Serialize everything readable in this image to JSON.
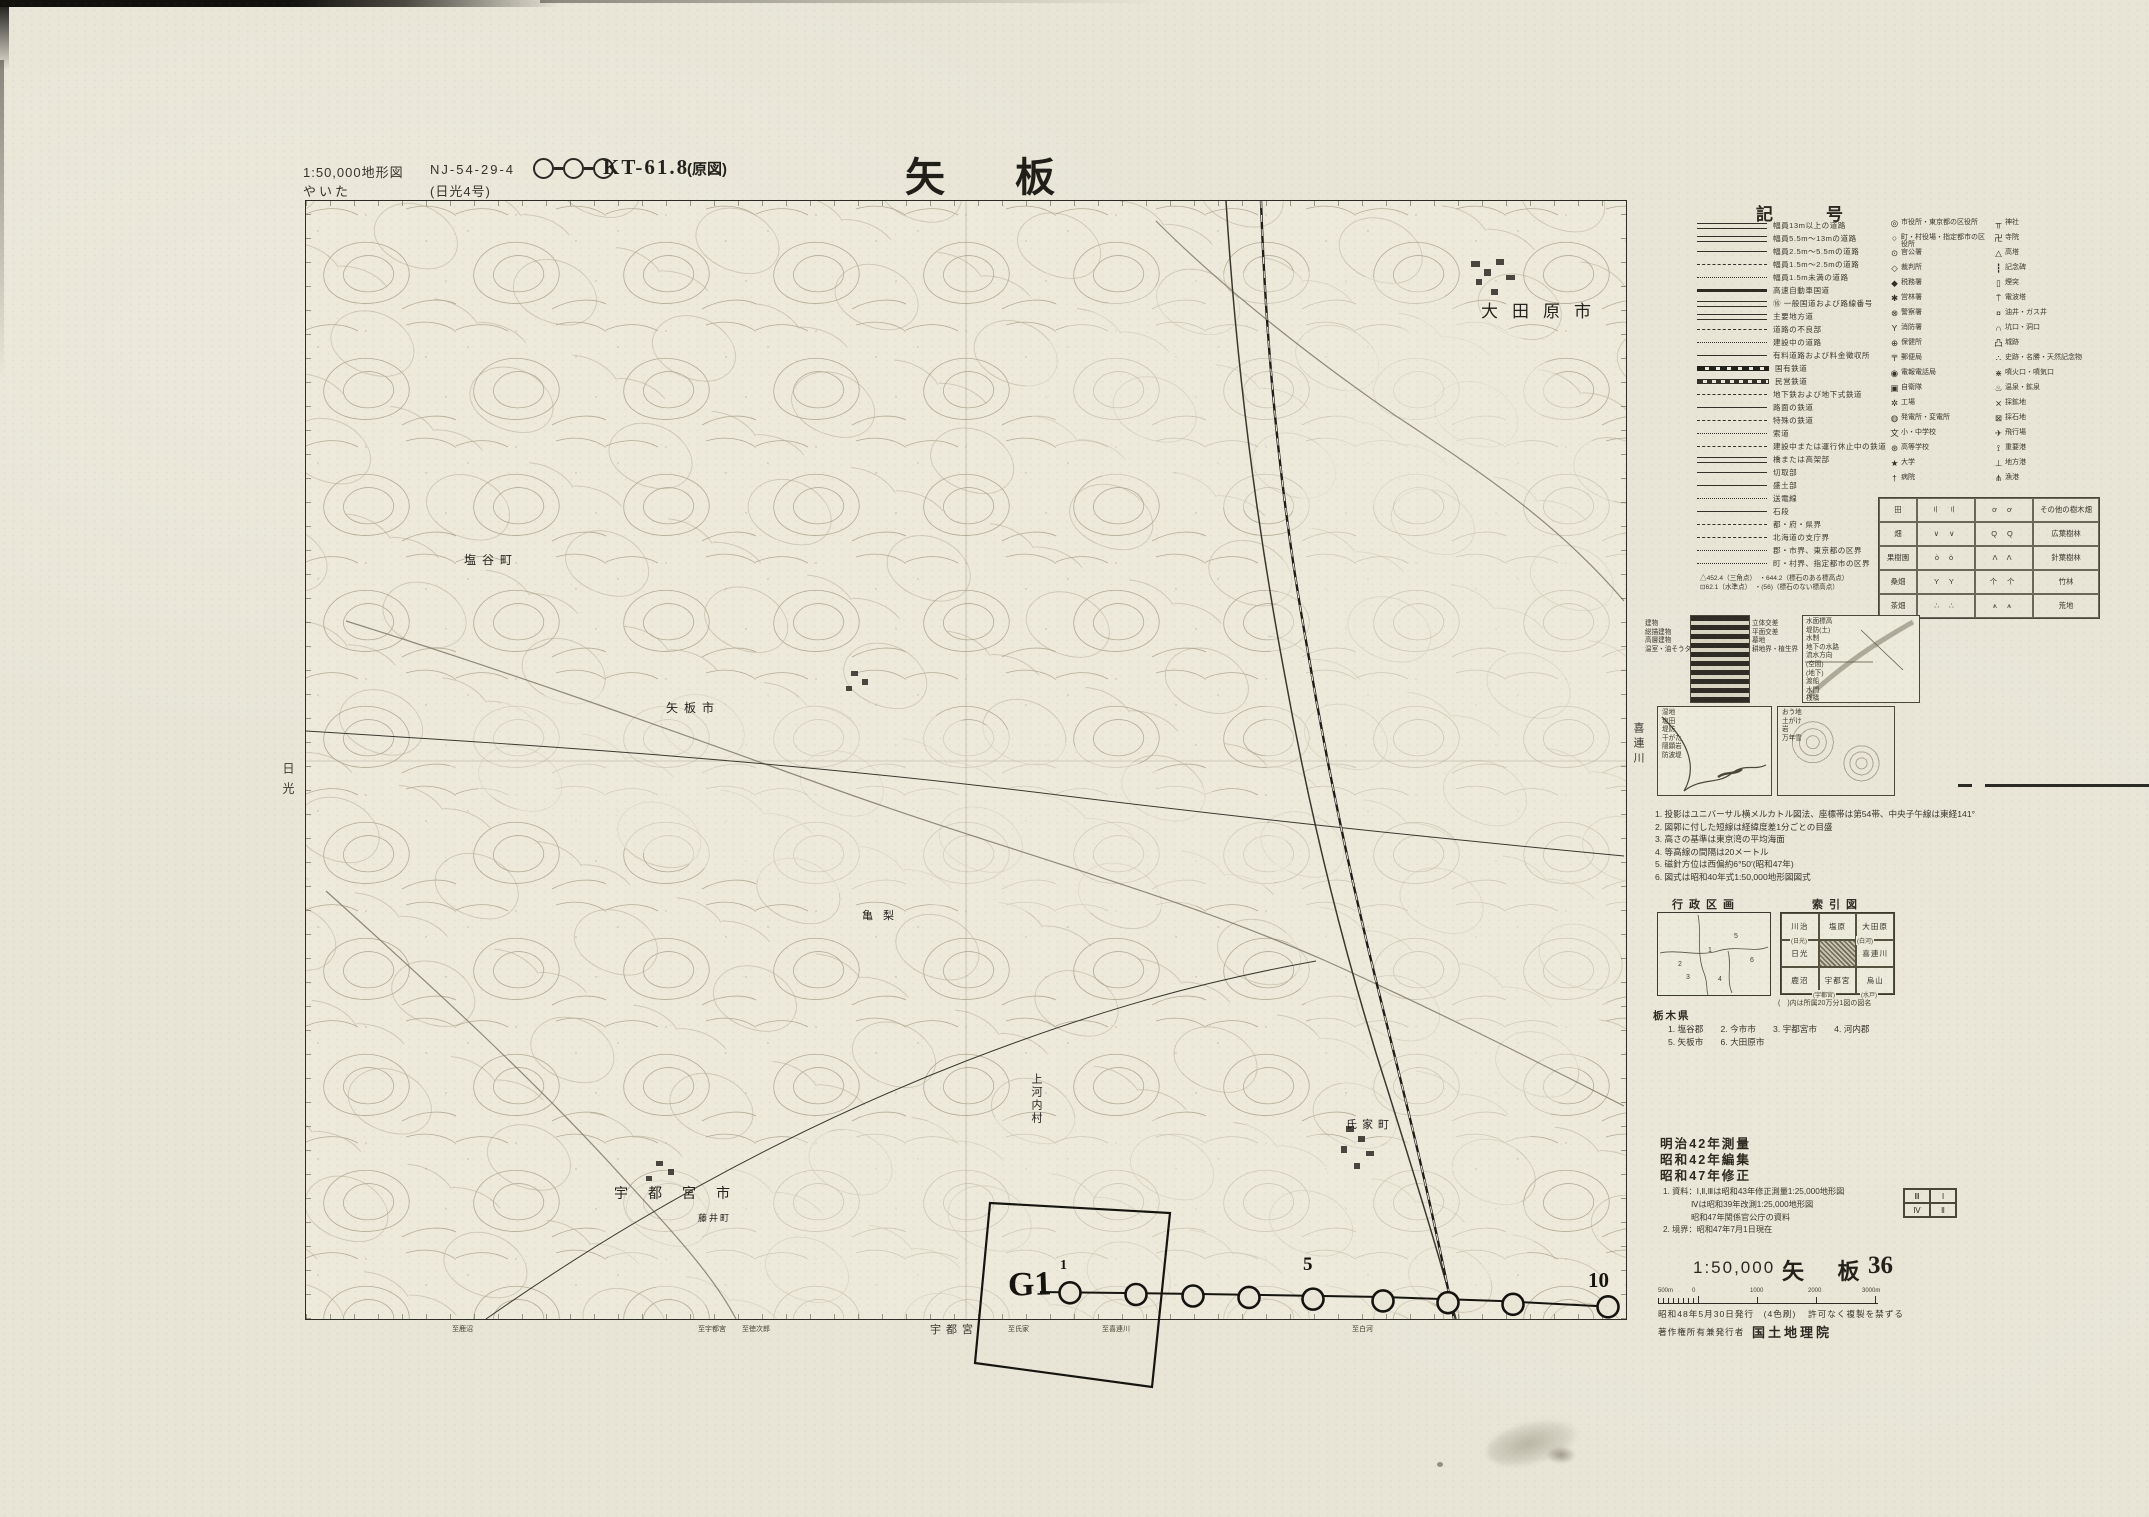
{
  "header": {
    "scale_note": "1:50,000地形図",
    "sheet_code": "NJ-54-29-4",
    "kana": "やいた",
    "series_note": "(日光4号)",
    "edition_code": "KT-61.8",
    "edition_note": "(原図)",
    "title": "矢 板",
    "adjoining_top": "塩原"
  },
  "map": {
    "adjoining_left": "日光",
    "adjoining_right": "喜連川",
    "adjoining_bottom": "宇都宮",
    "labels": [
      {
        "text": "大田原市",
        "x": 1175,
        "y": 96,
        "size": 17,
        "spacing": 14,
        "vertical": false
      },
      {
        "text": "塩谷町",
        "x": 158,
        "y": 350,
        "size": 12,
        "spacing": 6,
        "vertical": false
      },
      {
        "text": "矢板市",
        "x": 360,
        "y": 498,
        "size": 12,
        "spacing": 6,
        "vertical": false
      },
      {
        "text": "亀梨",
        "x": 556,
        "y": 706,
        "size": 11,
        "spacing": 10,
        "vertical": false
      },
      {
        "text": "上河内村",
        "x": 722,
        "y": 872,
        "size": 11,
        "spacing": 2,
        "vertical": true
      },
      {
        "text": "氏家町",
        "x": 1040,
        "y": 915,
        "size": 11,
        "spacing": 5,
        "vertical": false
      },
      {
        "text": "宇都宮市",
        "x": 308,
        "y": 982,
        "size": 14,
        "spacing": 20,
        "vertical": false
      },
      {
        "text": "藤井町",
        "x": 392,
        "y": 1010,
        "size": 9,
        "spacing": 2,
        "vertical": false
      }
    ],
    "edge_notes": [
      {
        "text": "至鹿沼",
        "x": 452
      },
      {
        "text": "至宇都宮",
        "x": 698
      },
      {
        "text": "至徳次郎",
        "x": 742
      },
      {
        "text": "至氏家",
        "x": 1008
      },
      {
        "text": "至喜連川",
        "x": 1102
      },
      {
        "text": "至白河",
        "x": 1352
      }
    ],
    "annotation": {
      "g1": "G1",
      "n1": "1",
      "n5": "5",
      "n10": "10"
    }
  },
  "legend": {
    "title": "記　号",
    "roads": [
      {
        "label": "幅員13m以上の道路",
        "s": "r-d2"
      },
      {
        "label": "幅員5.5m〜13mの道路",
        "s": "r-d2"
      },
      {
        "label": "幅員2.5m〜5.5mの道路",
        "s": "r-s"
      },
      {
        "label": "幅員1.5m〜2.5mの道路",
        "s": "r-dash"
      },
      {
        "label": "幅員1.5m未満の道路",
        "s": "r-dot"
      },
      {
        "label": "高速自動車国道",
        "s": "r-thick"
      },
      {
        "label": "⑯ 一般国道および路線番号",
        "s": "r-d2"
      },
      {
        "label": "主要地方道",
        "s": "r-d2"
      },
      {
        "label": "道路の不良部",
        "s": "r-dash"
      },
      {
        "label": "建設中の道路",
        "s": "r-dot"
      },
      {
        "label": "有料道路および料金徴収所",
        "s": "r-s"
      },
      {
        "label": "国有鉄道",
        "s": "r-rail"
      },
      {
        "label": "民営鉄道",
        "s": "r-rail2"
      },
      {
        "label": "地下鉄および地下式鉄道",
        "s": "r-dash"
      },
      {
        "label": "路面の鉄道",
        "s": "r-s"
      },
      {
        "label": "特殊の鉄道",
        "s": "r-dash"
      },
      {
        "label": "索道",
        "s": "r-dot"
      },
      {
        "label": "建設中または運行休止中の鉄道",
        "s": "r-dash"
      },
      {
        "label": "橋または高架部",
        "s": "r-d2"
      },
      {
        "label": "切取部",
        "s": "r-s"
      },
      {
        "label": "盛土部",
        "s": "r-s"
      },
      {
        "label": "送電線",
        "s": "r-dot"
      },
      {
        "label": "石段",
        "s": "r-s"
      },
      {
        "label": "都・府・県界",
        "s": "r-dash"
      },
      {
        "label": "北海道の支庁界",
        "s": "r-dash"
      },
      {
        "label": "郡・市界、東京都の区界",
        "s": "r-dot"
      },
      {
        "label": "町・村界、指定都市の区界",
        "s": "r-dot"
      }
    ],
    "symbols_a": [
      {
        "sym": "◎",
        "label": "市役所・東京都の区役所"
      },
      {
        "sym": "○",
        "label": "町・村役場・指定都市の区役所"
      },
      {
        "sym": "⊙",
        "label": "官公署"
      },
      {
        "sym": "◇",
        "label": "裁判所"
      },
      {
        "sym": "◆",
        "label": "税務署"
      },
      {
        "sym": "✱",
        "label": "営林署"
      },
      {
        "sym": "⊗",
        "label": "警察署"
      },
      {
        "sym": "Y",
        "label": "消防署"
      },
      {
        "sym": "⊕",
        "label": "保健所"
      },
      {
        "sym": "〒",
        "label": "郵便局"
      },
      {
        "sym": "◉",
        "label": "電報電話局"
      },
      {
        "sym": "▣",
        "label": "自衛隊"
      },
      {
        "sym": "✲",
        "label": "工場"
      },
      {
        "sym": "◍",
        "label": "発電所・変電所"
      },
      {
        "sym": "文",
        "label": "小・中学校"
      },
      {
        "sym": "⊛",
        "label": "高等学校"
      },
      {
        "sym": "★",
        "label": "大学"
      },
      {
        "sym": "†",
        "label": "病院"
      }
    ],
    "symbols_b": [
      {
        "sym": "╥",
        "label": "神社"
      },
      {
        "sym": "卍",
        "label": "寺院"
      },
      {
        "sym": "△",
        "label": "高塔"
      },
      {
        "sym": "┇",
        "label": "記念碑"
      },
      {
        "sym": "▯",
        "label": "煙突"
      },
      {
        "sym": "⍑",
        "label": "電波塔"
      },
      {
        "sym": "¤",
        "label": "油井・ガス井"
      },
      {
        "sym": "∩",
        "label": "坑口・洞口"
      },
      {
        "sym": "凸",
        "label": "城跡"
      },
      {
        "sym": "∴",
        "label": "史跡・名勝・天然記念物"
      },
      {
        "sym": "⋇",
        "label": "噴火口・噴気口"
      },
      {
        "sym": "♨",
        "label": "温泉・鉱泉"
      },
      {
        "sym": "⨯",
        "label": "採鉱地"
      },
      {
        "sym": "⊠",
        "label": "採石地"
      },
      {
        "sym": "✈",
        "label": "飛行場"
      },
      {
        "sym": "⟟",
        "label": "重要港"
      },
      {
        "sym": "⊥",
        "label": "地方港"
      },
      {
        "sym": "⋔",
        "label": "漁港"
      }
    ],
    "elevation_notes": [
      "△452.4（三角点）　・644.2（標石のある標高点）",
      "⊡62.1（水準点）　・(56)（標石のない標高点）"
    ],
    "landuse": {
      "rows": [
        {
          "left": "田",
          "lsw": "〢 〢",
          "rsw": "ơ ơ",
          "right": "その他の樹木畑"
        },
        {
          "left": "畑",
          "lsw": "∨ ∨",
          "rsw": "Q Q",
          "right": "広葉樹林"
        },
        {
          "left": "果樹園",
          "lsw": "ò ò",
          "rsw": "Λ Λ",
          "right": "針葉樹林"
        },
        {
          "left": "桑畑",
          "lsw": "Y Y",
          "rsw": "个 个",
          "right": "竹林"
        },
        {
          "left": "茶畑",
          "lsw": "∴ ∴",
          "rsw": "⩚ ⩚",
          "right": "荒地"
        }
      ]
    },
    "samples": {
      "city_left": [
        "建物",
        "総描建物",
        "高層建物",
        "温室・油そうタンク等"
      ],
      "city_right": [
        "立体交差",
        "平面交差",
        "墓地",
        "耕地界・植生界"
      ],
      "water": [
        "水面標高",
        "堤防(土)",
        "水制",
        "地下の水路",
        "流水方向",
        "(空間)",
        "(地下)",
        "渡船",
        "水門",
        "桟橋"
      ],
      "coast": [
        "湿地",
        "塩田",
        "堤防",
        "干がた",
        "隠顕岩",
        "防波堤"
      ],
      "contour": [
        "おう地",
        "土がけ",
        "岩",
        "万年雪"
      ]
    },
    "notes": [
      "1. 投影はユニバーサル横メルカトル図法、座標帯は第54帯、中央子午線は東経141°",
      "2. 図郭に付した短線は経緯度差1分ごとの目盛",
      "3. 高さの基準は東京湾の平均海面",
      "4. 等高線の間隔は20メートル",
      "5. 磁針方位は西偏約6°50′(昭和47年)",
      "6. 図式は昭和40年式1:50,000地形図図式"
    ],
    "admin_title": "行政区画",
    "admin_numbers": [
      {
        "n": "1",
        "x": 50,
        "y": 34
      },
      {
        "n": "2",
        "x": 20,
        "y": 48
      },
      {
        "n": "3",
        "x": 28,
        "y": 61
      },
      {
        "n": "4",
        "x": 60,
        "y": 63
      },
      {
        "n": "5",
        "x": 76,
        "y": 20
      },
      {
        "n": "6",
        "x": 92,
        "y": 44
      }
    ],
    "index_title": "索引図",
    "index_grid": [
      [
        "川治",
        "塩原",
        "大田原"
      ],
      [
        "日光",
        "矢板",
        "喜連川"
      ],
      [
        "鹿沼",
        "宇都宮",
        "烏山"
      ]
    ],
    "index_sheet_names": [
      {
        "text": "(日光)",
        "x": 10,
        "y": 24
      },
      {
        "text": "(白河)",
        "x": 76,
        "y": 24
      },
      {
        "text": "(宇都宮)",
        "x": 32,
        "y": 78
      },
      {
        "text": "(水戸)",
        "x": 80,
        "y": 78
      }
    ],
    "index_note": "(　)内は所属20万分1図の図名",
    "prefecture": {
      "name": "栃木県",
      "lines": [
        "1. 塩谷郡　　2. 今市市　　3. 宇都宮市　　4. 河内郡",
        "5. 矢板市　　6. 大田原市"
      ]
    }
  },
  "imprint": {
    "history": [
      "明治42年測量",
      "昭和42年編集",
      "昭和47年修正"
    ],
    "source_notes": [
      "1. 資料：Ⅰ,Ⅱ,Ⅲは昭和43年修正測量1:25,000地形図",
      "Ⅳは昭和39年改測1:25,000地形図",
      "昭和47年関係官公庁の資料",
      "2. 境界：昭和47年7月1日現在"
    ],
    "quadrant": [
      [
        "Ⅲ",
        "Ⅰ"
      ],
      [
        "Ⅳ",
        "Ⅱ"
      ]
    ],
    "scale": "1:50,000",
    "sheet_name": "矢 板",
    "sheet_number": "36",
    "scalebar_labels": [
      "500m",
      "0",
      "1000",
      "2000",
      "3000m"
    ],
    "publication": "昭和48年5月30日発行　(4色刷)",
    "copyright_note": "許可なく複製を禁ずる",
    "publisher_label": "著作権所有兼発行者",
    "publisher": "国土地理院"
  }
}
